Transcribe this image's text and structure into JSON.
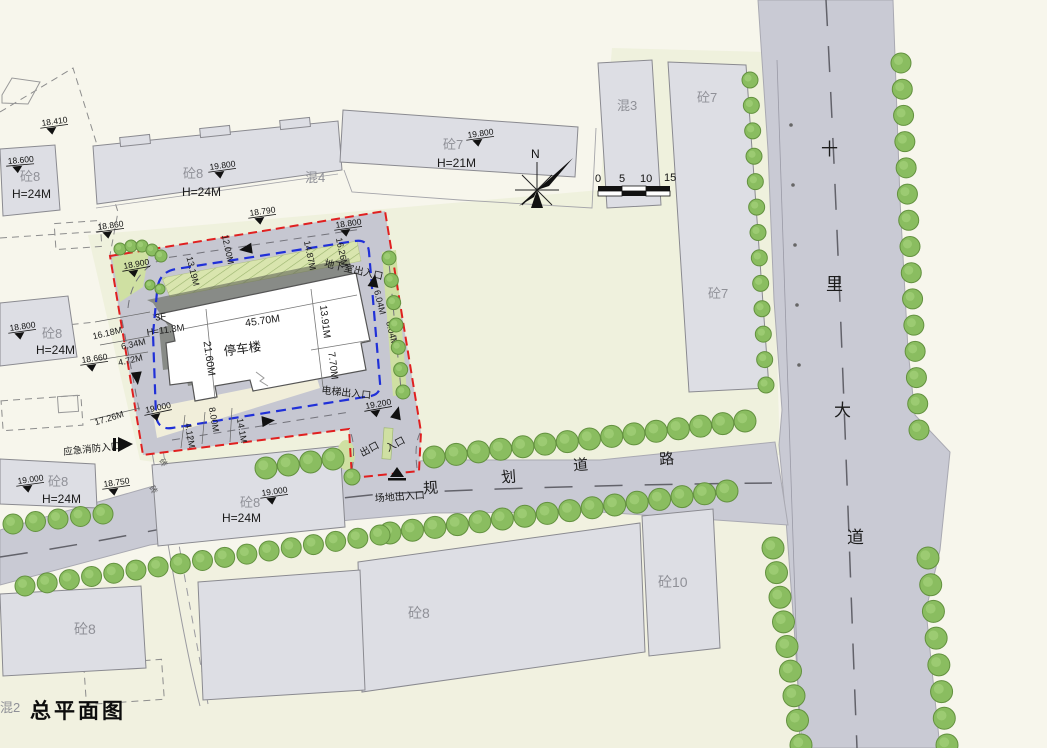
{
  "title": "总平面图",
  "north_label": "N",
  "scale_ticks": [
    "0",
    "5",
    "10",
    "15"
  ],
  "roads": {
    "vertical_chars": [
      "十",
      "里",
      "大",
      "道"
    ],
    "horizontal_chars": [
      "规",
      "划",
      "道",
      "路"
    ]
  },
  "parking": {
    "name": "停车楼",
    "floors": "3F",
    "height": "H=11.3M",
    "dim_top": "45.70M",
    "dim_left": "21.60M",
    "dim_right_upper": "13.91M",
    "dim_right_lower": "7.70M"
  },
  "site_dims": {
    "west1": "16.18M",
    "west2": "6.34M",
    "west3": "4.72M",
    "west4": "17.26M",
    "north1": "13.19M",
    "north2": "12.00M",
    "north3": "14.87M",
    "north4": "16.26M",
    "east1": "6.04M",
    "east2": "6.04M",
    "south1": "4.12M",
    "south2": "8.00M",
    "south3": "14.1M"
  },
  "entrances": {
    "basement": "地下室出入口",
    "elevator": "电梯出入口",
    "site_gate": "场地出入口",
    "exit": "出口",
    "entry": "入口",
    "emergency": "应急消防入口"
  },
  "buildings": {
    "b1": {
      "mat": "砼8",
      "h": "H=24M"
    },
    "b2": {
      "mat": "砼8",
      "h": "H=24M",
      "elev": "19.800",
      "annex": "混4"
    },
    "b3": {
      "mat": "砼7",
      "h": "H=21M",
      "elev": "19.800"
    },
    "b4": {
      "mat": "混3"
    },
    "b5": {
      "mat": "砼7",
      "mat2": "砼7"
    },
    "b6": {
      "mat": "砼8",
      "h": "H=24M",
      "elev": "18.800"
    },
    "b7": {
      "mat": "砼8",
      "h": "H=24M",
      "elev": "19.000"
    },
    "b8": {
      "mat": "砼8",
      "h": "H=24M",
      "elev": "19.000"
    },
    "b9": {
      "mat": "砼8"
    },
    "b10": {
      "mat": "砼10"
    },
    "b11": {
      "mat": "砼8"
    },
    "b12": {
      "mat": "混2"
    }
  },
  "elevations": {
    "e1": "18.410",
    "e2": "18.600",
    "e4": "18.790",
    "e5": "18.800",
    "e6": "18.860",
    "e7": "18.900",
    "e10": "18.660",
    "e12": "18.750",
    "e13": "19.000",
    "e15": "19.200"
  },
  "notes": {
    "brick1": "砖",
    "brick2": "砖"
  }
}
